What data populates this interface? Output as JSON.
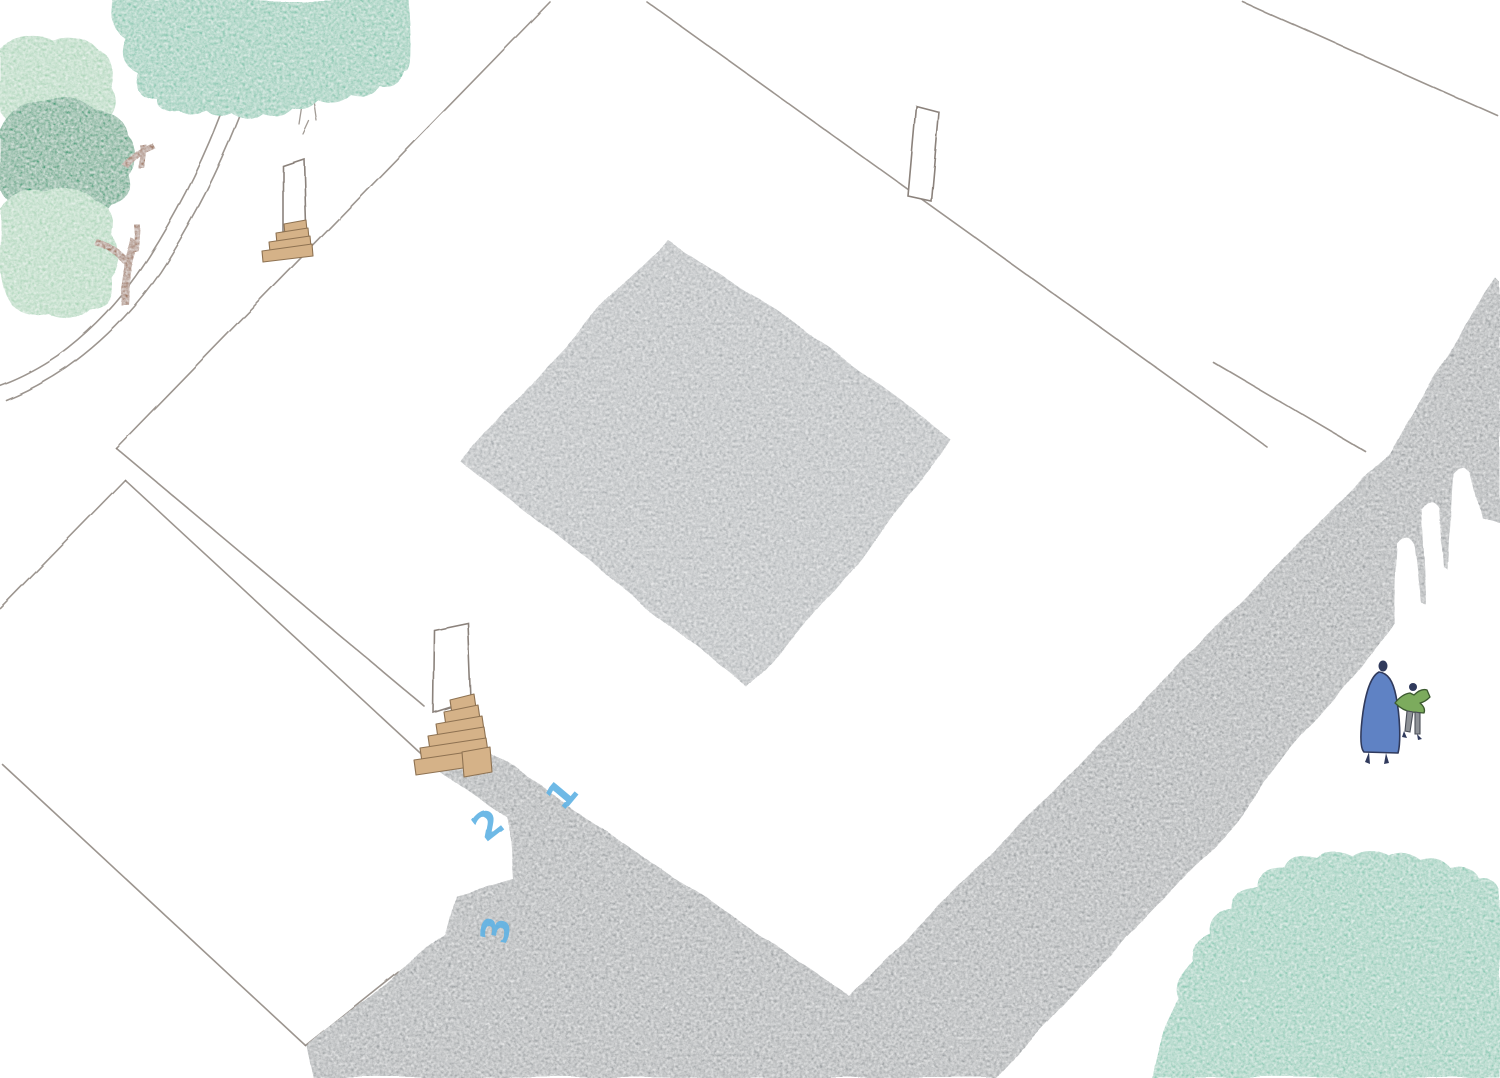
{
  "scene": {
    "type": "hand-drawn aerial architectural illustration",
    "description": "Watercolor site plan of a courtyard building with entry steps, arched shadow, trees and two walking figures",
    "annotations": {
      "label_1": "1",
      "label_2": "2",
      "label_3": "3"
    },
    "colors": {
      "paper": "#ffffff",
      "pencil": "#8b827b",
      "courtyard_gray": "#a9adb0",
      "shadow_gray": "#9ca0a3",
      "tree_teal": "#7fc4ac",
      "tree_teal_2": "#85c7b1",
      "tree_pale": "#a7d3b5",
      "tree_dark": "#3f9d77",
      "tree_muted": "#9bcec0",
      "branch_brown": "#96684c",
      "wood_fill": "#d5b288",
      "wood_line": "#8e7252",
      "number_blue": "#5fb2e4",
      "coat_blue": "#5f82c4",
      "figure_navy": "#303a5c",
      "jacket_green": "#7cab5d",
      "pants_gray": "#8d9196"
    }
  }
}
